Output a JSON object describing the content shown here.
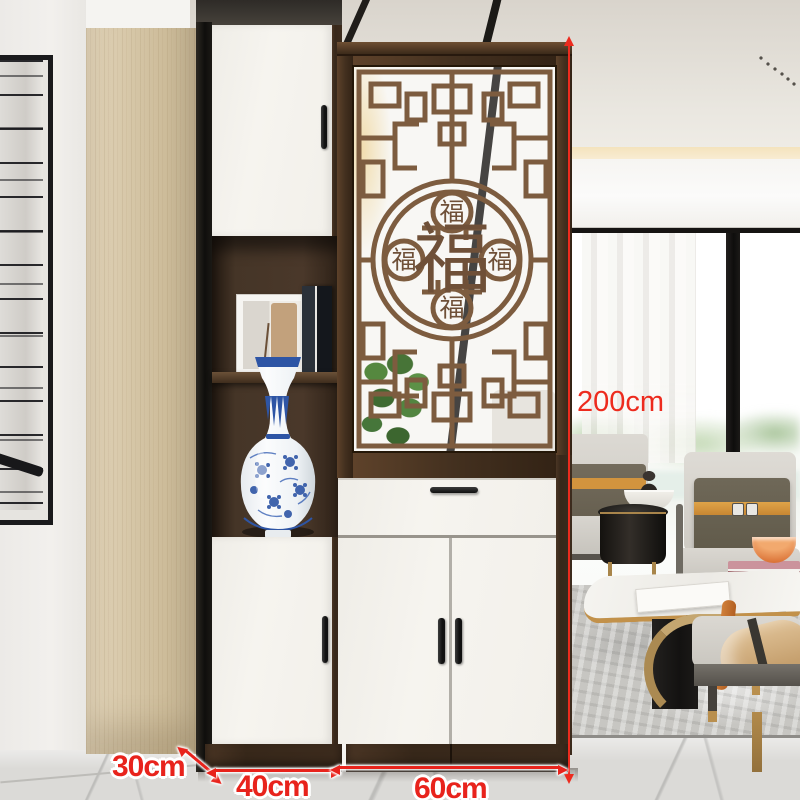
{
  "dimensions": {
    "height_label": "200cm",
    "depth_label": "30cm",
    "left_width_label": "40cm",
    "right_width_label": "60cm",
    "annotation_color": "#e8231c"
  },
  "screen_panel": {
    "center_character": "福",
    "small_characters": [
      "福",
      "福",
      "福",
      "福"
    ]
  },
  "icons": {
    "height_arrow": "double-headed-vertical-arrow",
    "depth_arrow": "double-headed-diagonal-arrow",
    "width_arrow_left": "double-headed-horizontal-arrow",
    "width_arrow_right": "double-headed-horizontal-arrow"
  },
  "palette": {
    "annotation_red": "#e8231c",
    "frame_wood": "#4a3424",
    "lattice_wood": "#7b5a3e",
    "cabinet_white": "#f4f2ed",
    "accent_panel_wood": "#d8c6a2",
    "porcelain_blue": "#2e55a5"
  }
}
